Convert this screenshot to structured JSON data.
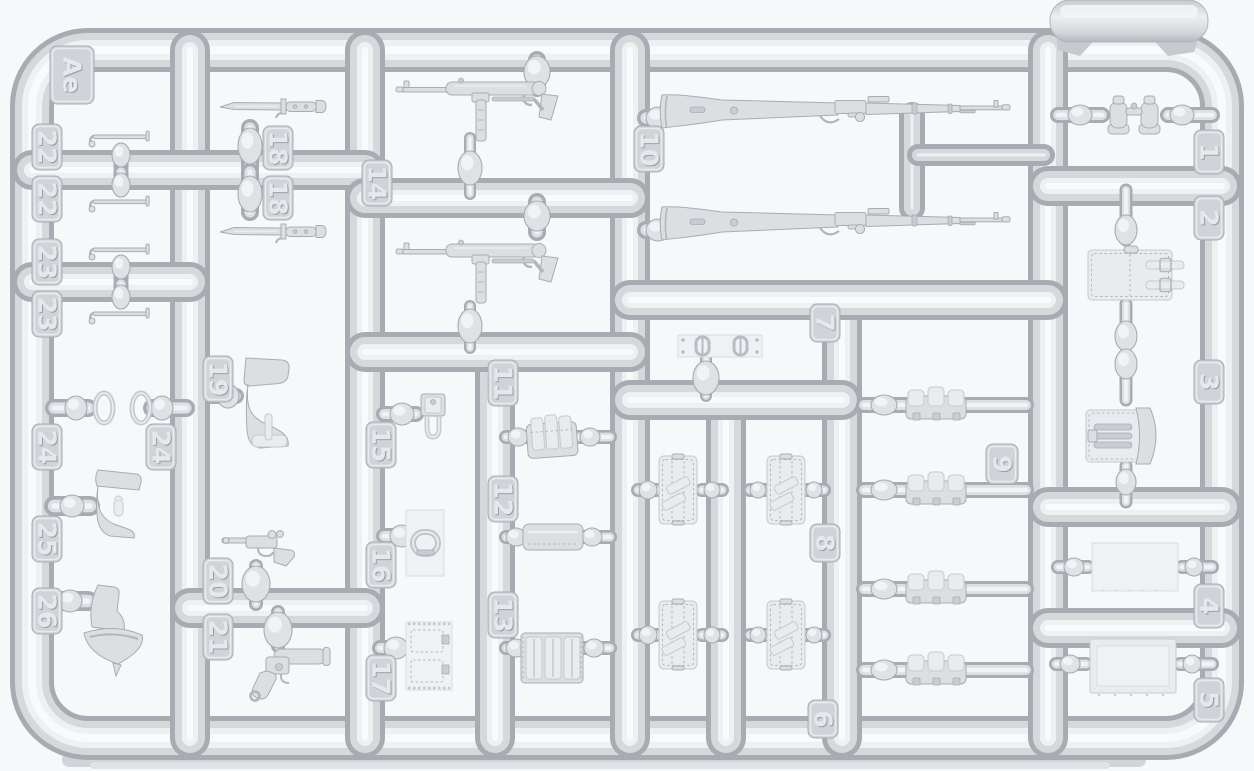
{
  "scene": {
    "description": "Photograph of a light-grey injection-molded plastic model kit sprue (runner frame) holding small-scale weapon and equipment parts",
    "plastic_color": "#d7d9dd",
    "background_color": "#f7f8f9",
    "shadow_color": "#d2d4d8"
  },
  "sprue": {
    "code": "Ae",
    "frame": {
      "x": 32,
      "y": 50,
      "w": 1190,
      "h": 688,
      "r": 56,
      "thickness": 44
    },
    "runners": [
      [
        190,
        50,
        190,
        738
      ],
      [
        365,
        50,
        365,
        738
      ],
      [
        495,
        352,
        495,
        738
      ],
      [
        630,
        50,
        630,
        738
      ],
      [
        726,
        400,
        726,
        738
      ],
      [
        842,
        300,
        842,
        738
      ],
      [
        1048,
        50,
        1048,
        738
      ],
      [
        32,
        170,
        365,
        170
      ],
      [
        32,
        282,
        190,
        282
      ],
      [
        365,
        198,
        630,
        198
      ],
      [
        365,
        352,
        630,
        352
      ],
      [
        630,
        300,
        1048,
        300
      ],
      [
        630,
        400,
        842,
        400
      ],
      [
        1048,
        186,
        1222,
        186
      ],
      [
        1048,
        507,
        1222,
        507
      ],
      [
        1048,
        628,
        1222,
        628
      ],
      [
        190,
        608,
        365,
        608
      ],
      [
        912,
        115,
        912,
        208,
        26
      ],
      [
        918,
        155,
        1044,
        155,
        22
      ]
    ],
    "gates": [
      [
        121,
        150,
        121,
        168,
        15
      ],
      [
        121,
        172,
        121,
        190,
        15
      ],
      [
        121,
        262,
        121,
        280,
        15
      ],
      [
        121,
        284,
        121,
        302,
        15
      ],
      [
        54,
        408,
        88,
        408,
        18
      ],
      [
        152,
        408,
        186,
        408,
        18
      ],
      [
        54,
        506,
        90,
        506,
        20
      ],
      [
        54,
        601,
        88,
        601,
        20
      ],
      [
        250,
        128,
        250,
        168,
        18
      ],
      [
        250,
        172,
        250,
        212,
        18
      ],
      [
        212,
        396,
        236,
        396,
        16
      ],
      [
        256,
        566,
        256,
        604,
        14
      ],
      [
        278,
        612,
        278,
        646,
        14
      ],
      [
        537,
        60,
        537,
        88,
        18
      ],
      [
        470,
        138,
        470,
        194,
        12
      ],
      [
        537,
        202,
        537,
        232,
        18
      ],
      [
        470,
        306,
        470,
        348,
        12
      ],
      [
        384,
        414,
        416,
        414,
        16
      ],
      [
        384,
        536,
        416,
        536,
        16
      ],
      [
        380,
        648,
        410,
        648,
        16
      ],
      [
        506,
        437,
        528,
        437,
        14
      ],
      [
        576,
        437,
        610,
        437,
        14
      ],
      [
        506,
        537,
        526,
        537,
        14
      ],
      [
        578,
        537,
        610,
        537,
        14
      ],
      [
        506,
        648,
        526,
        648,
        14
      ],
      [
        580,
        648,
        610,
        648,
        14
      ],
      [
        646,
        118,
        666,
        118,
        18
      ],
      [
        646,
        230,
        666,
        230,
        18
      ],
      [
        706,
        358,
        706,
        396,
        12
      ],
      [
        638,
        490,
        657,
        490,
        14
      ],
      [
        702,
        490,
        722,
        490,
        14
      ],
      [
        750,
        490,
        768,
        490,
        14
      ],
      [
        806,
        490,
        824,
        490,
        14
      ],
      [
        638,
        635,
        657,
        635,
        14
      ],
      [
        702,
        635,
        722,
        635,
        14
      ],
      [
        750,
        635,
        768,
        635,
        14
      ],
      [
        806,
        635,
        824,
        635,
        14
      ],
      [
        864,
        405,
        906,
        405,
        16
      ],
      [
        963,
        405,
        1026,
        405,
        16
      ],
      [
        864,
        490,
        906,
        490,
        16
      ],
      [
        963,
        490,
        1026,
        490,
        16
      ],
      [
        864,
        589,
        906,
        589,
        16
      ],
      [
        963,
        589,
        1026,
        589,
        16
      ],
      [
        864,
        670,
        906,
        670,
        16
      ],
      [
        963,
        670,
        1026,
        670,
        16
      ],
      [
        1058,
        115,
        1102,
        115,
        16
      ],
      [
        1168,
        115,
        1212,
        115,
        16
      ],
      [
        1126,
        190,
        1126,
        240,
        13
      ],
      [
        1126,
        304,
        1126,
        346,
        13
      ],
      [
        1126,
        354,
        1126,
        400,
        13
      ],
      [
        1126,
        466,
        1126,
        502,
        13
      ],
      [
        1058,
        567,
        1088,
        567,
        14
      ],
      [
        1182,
        567,
        1212,
        567,
        14
      ],
      [
        1056,
        664,
        1086,
        664,
        14
      ],
      [
        1180,
        664,
        1212,
        664,
        14
      ]
    ],
    "bulbs": [
      [
        121,
        155,
        9,
        12
      ],
      [
        121,
        185,
        9,
        12
      ],
      [
        121,
        267,
        9,
        12
      ],
      [
        121,
        297,
        9,
        12
      ],
      [
        76,
        408,
        11,
        12
      ],
      [
        162,
        408,
        11,
        12
      ],
      [
        72,
        506,
        12,
        11
      ],
      [
        70,
        601,
        12,
        11
      ],
      [
        250,
        146,
        12,
        18
      ],
      [
        250,
        194,
        12,
        18
      ],
      [
        228,
        396,
        11,
        12
      ],
      [
        256,
        584,
        14,
        18
      ],
      [
        278,
        630,
        14,
        18
      ],
      [
        537,
        72,
        13,
        16
      ],
      [
        470,
        168,
        12,
        17
      ],
      [
        537,
        216,
        13,
        15
      ],
      [
        470,
        326,
        12,
        17
      ],
      [
        402,
        414,
        12,
        11
      ],
      [
        402,
        536,
        12,
        11
      ],
      [
        396,
        648,
        12,
        11
      ],
      [
        518,
        437,
        10,
        9
      ],
      [
        590,
        437,
        10,
        9
      ],
      [
        516,
        537,
        10,
        9
      ],
      [
        592,
        537,
        10,
        9
      ],
      [
        516,
        648,
        10,
        9
      ],
      [
        594,
        648,
        10,
        9
      ],
      [
        658,
        118,
        12,
        11
      ],
      [
        658,
        230,
        12,
        11
      ],
      [
        706,
        378,
        13,
        17
      ],
      [
        648,
        490,
        9,
        9
      ],
      [
        712,
        490,
        8,
        8
      ],
      [
        758,
        490,
        8,
        8
      ],
      [
        814,
        490,
        8,
        8
      ],
      [
        648,
        635,
        9,
        9
      ],
      [
        712,
        635,
        8,
        8
      ],
      [
        758,
        635,
        8,
        8
      ],
      [
        814,
        635,
        8,
        8
      ],
      [
        884,
        405,
        13,
        10
      ],
      [
        884,
        490,
        13,
        10
      ],
      [
        884,
        589,
        13,
        10
      ],
      [
        884,
        670,
        13,
        10
      ],
      [
        1080,
        115,
        12,
        10
      ],
      [
        1182,
        115,
        12,
        10
      ],
      [
        1126,
        230,
        11,
        15
      ],
      [
        1126,
        336,
        11,
        15
      ],
      [
        1126,
        364,
        11,
        15
      ],
      [
        1126,
        482,
        10,
        13
      ],
      [
        1074,
        567,
        10,
        9
      ],
      [
        1194,
        567,
        9,
        9
      ],
      [
        1070,
        664,
        10,
        9
      ],
      [
        1192,
        664,
        9,
        9
      ]
    ],
    "tabs": [
      {
        "label": "Ae",
        "x": 50,
        "y": 46,
        "w": 44,
        "h": 58
      },
      {
        "label": "22",
        "x": 32,
        "y": 124,
        "w": 30,
        "h": 46
      },
      {
        "label": "22",
        "x": 32,
        "y": 176,
        "w": 30,
        "h": 46
      },
      {
        "label": "23",
        "x": 32,
        "y": 239,
        "w": 30,
        "h": 46
      },
      {
        "label": "23",
        "x": 32,
        "y": 291,
        "w": 30,
        "h": 46
      },
      {
        "label": "24",
        "x": 32,
        "y": 424,
        "w": 30,
        "h": 46
      },
      {
        "label": "24",
        "x": 146,
        "y": 424,
        "w": 30,
        "h": 46
      },
      {
        "label": "25",
        "x": 32,
        "y": 516,
        "w": 30,
        "h": 46
      },
      {
        "label": "26",
        "x": 32,
        "y": 588,
        "w": 30,
        "h": 46
      },
      {
        "label": "18",
        "x": 263,
        "y": 126,
        "w": 30,
        "h": 44
      },
      {
        "label": "18",
        "x": 263,
        "y": 176,
        "w": 30,
        "h": 44
      },
      {
        "label": "19",
        "x": 203,
        "y": 356,
        "w": 30,
        "h": 46
      },
      {
        "label": "20",
        "x": 203,
        "y": 558,
        "w": 30,
        "h": 46
      },
      {
        "label": "21",
        "x": 203,
        "y": 614,
        "w": 30,
        "h": 46
      },
      {
        "label": "14",
        "x": 362,
        "y": 160,
        "w": 30,
        "h": 46
      },
      {
        "label": "15",
        "x": 366,
        "y": 422,
        "w": 30,
        "h": 46
      },
      {
        "label": "16",
        "x": 366,
        "y": 542,
        "w": 30,
        "h": 46
      },
      {
        "label": "17",
        "x": 366,
        "y": 655,
        "w": 30,
        "h": 46
      },
      {
        "label": "11",
        "x": 488,
        "y": 360,
        "w": 30,
        "h": 46
      },
      {
        "label": "12",
        "x": 488,
        "y": 476,
        "w": 30,
        "h": 46
      },
      {
        "label": "13",
        "x": 488,
        "y": 592,
        "w": 30,
        "h": 46
      },
      {
        "label": "10",
        "x": 634,
        "y": 126,
        "w": 30,
        "h": 46
      },
      {
        "label": "7",
        "x": 810,
        "y": 304,
        "w": 30,
        "h": 38
      },
      {
        "label": "8",
        "x": 810,
        "y": 524,
        "w": 30,
        "h": 38
      },
      {
        "label": "6",
        "x": 808,
        "y": 700,
        "w": 30,
        "h": 38
      },
      {
        "label": "9",
        "x": 986,
        "y": 444,
        "w": 32,
        "h": 40
      },
      {
        "label": "1",
        "x": 1194,
        "y": 130,
        "w": 30,
        "h": 44
      },
      {
        "label": "2",
        "x": 1194,
        "y": 196,
        "w": 30,
        "h": 44
      },
      {
        "label": "3",
        "x": 1194,
        "y": 360,
        "w": 30,
        "h": 44
      },
      {
        "label": "4",
        "x": 1194,
        "y": 584,
        "w": 30,
        "h": 44
      },
      {
        "label": "5",
        "x": 1194,
        "y": 678,
        "w": 30,
        "h": 44
      }
    ],
    "parts": [
      {
        "number": "1",
        "name": "binoculars",
        "quantity": 1
      },
      {
        "number": "2",
        "name": "equipment flap with two buckled straps",
        "quantity": 1
      },
      {
        "number": "3",
        "name": "tool pouch with flap",
        "quantity": 1
      },
      {
        "number": "4",
        "name": "flat panel",
        "quantity": 1
      },
      {
        "number": "5",
        "name": "flat case panel",
        "quantity": 1
      },
      {
        "number": "6",
        "name": "flat bag",
        "quantity": 2
      },
      {
        "number": "7",
        "name": "strip with two buckles",
        "quantity": 1
      },
      {
        "number": "8",
        "name": "flat bag",
        "quantity": 2
      },
      {
        "number": "9",
        "name": "triple ammunition pouch",
        "quantity": 4
      },
      {
        "number": "10",
        "name": "bolt-action rifle",
        "quantity": 2
      },
      {
        "number": "11",
        "name": "magazine pouch",
        "quantity": 1
      },
      {
        "number": "12",
        "name": "flat pouch body",
        "quantity": 1
      },
      {
        "number": "13",
        "name": "magazine pouch with straps",
        "quantity": 1
      },
      {
        "number": "14",
        "name": "submachine gun",
        "quantity": 2
      },
      {
        "number": "15",
        "name": "small carrier with loop",
        "quantity": 1
      },
      {
        "number": "16",
        "name": "oval buckle",
        "quantity": 1
      },
      {
        "number": "17",
        "name": "flat pouch panel",
        "quantity": 1
      },
      {
        "number": "18",
        "name": "bayonet",
        "quantity": 2
      },
      {
        "number": "19",
        "name": "pistol holster",
        "quantity": 1
      },
      {
        "number": "20",
        "name": "pistol",
        "quantity": 1
      },
      {
        "number": "21",
        "name": "flare pistol",
        "quantity": 1
      },
      {
        "number": "22",
        "name": "small rod",
        "quantity": 2
      },
      {
        "number": "23",
        "name": "small rod",
        "quantity": 2
      },
      {
        "number": "24",
        "name": "oval ring",
        "quantity": 2
      },
      {
        "number": "25",
        "name": "small holster",
        "quantity": 1
      },
      {
        "number": "26",
        "name": "holster with flap",
        "quantity": 1
      }
    ]
  }
}
